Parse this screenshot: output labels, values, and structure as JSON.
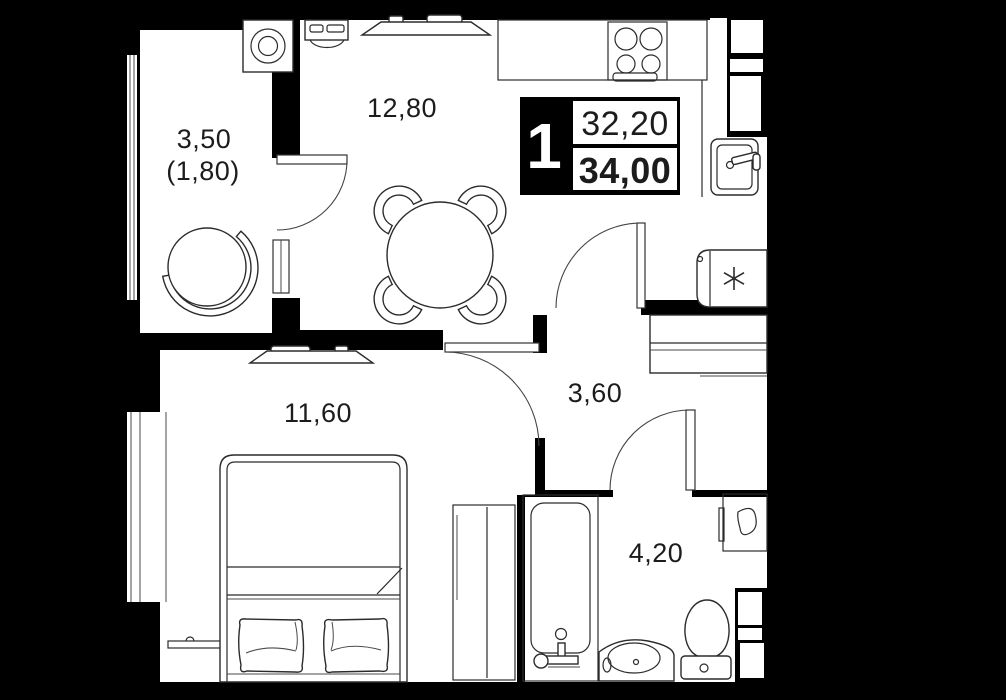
{
  "badge": {
    "room_count": "1",
    "area_living": "32,20",
    "area_total": "34,00"
  },
  "rooms": {
    "loggia": {
      "area": "3,50",
      "area_reduced": "(1,80)"
    },
    "kitchen_living": {
      "area": "12,80"
    },
    "bedroom": {
      "area": "11,60"
    },
    "hallway": {
      "area": "3,60"
    },
    "bathroom": {
      "area": "4,20"
    }
  },
  "colors": {
    "background": "#000000",
    "floor": "#ffffff",
    "line": "#2b2b2b",
    "label": "#1c1c1c"
  },
  "furniture_icons": [
    "washing-machine-icon",
    "oven-icon",
    "tv-icon",
    "kitchen-counter",
    "stove-icon",
    "kitchen-sink-icon",
    "refrigerator-icon",
    "dining-table-icon",
    "chair-icon",
    "armchair-icon",
    "hall-cabinet",
    "wardrobe",
    "bed-icon",
    "pillow-icon",
    "radiator",
    "bathtub-icon",
    "vanity-sink-icon",
    "toilet-icon",
    "bathroom-cabinet"
  ]
}
